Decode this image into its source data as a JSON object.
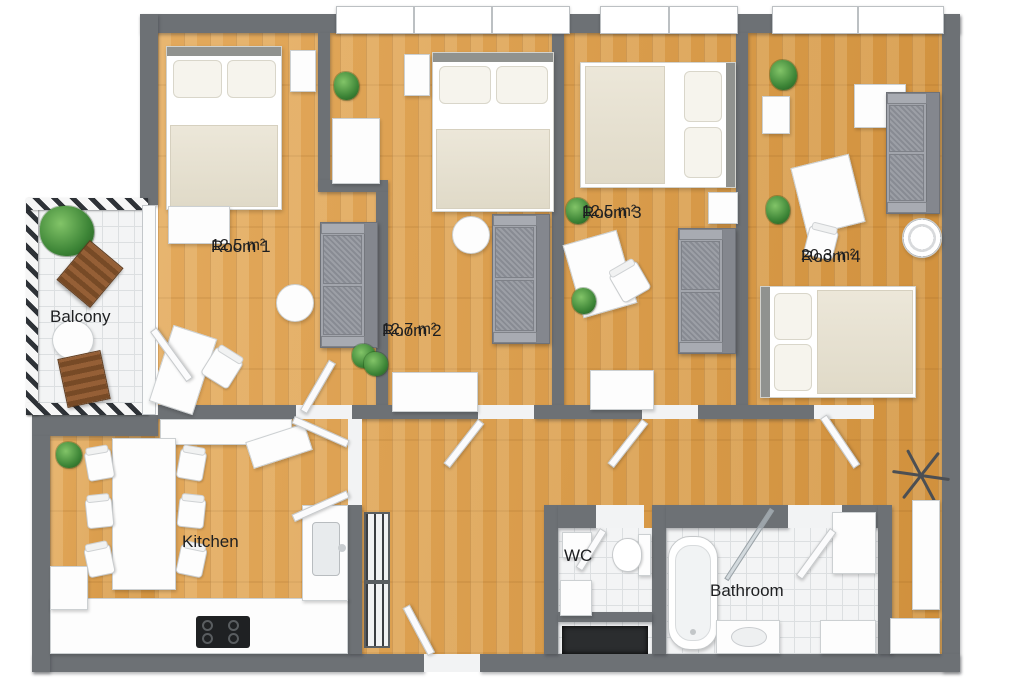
{
  "plan": {
    "type": "apartment-floor-plan-3d",
    "rooms": [
      {
        "id": "room-1",
        "name": "Room 1",
        "area": "12,5 m²"
      },
      {
        "id": "room-2",
        "name": "Room 2",
        "area": "12,7 m²"
      },
      {
        "id": "room-3",
        "name": "Room 3",
        "area": "12,5 m²"
      },
      {
        "id": "room-4",
        "name": "Room 4",
        "area": "20,3 m²"
      },
      {
        "id": "balcony",
        "name": "Balcony",
        "area": ""
      },
      {
        "id": "kitchen",
        "name": "Kitchen",
        "area": ""
      },
      {
        "id": "wc",
        "name": "WC",
        "area": ""
      },
      {
        "id": "bathroom",
        "name": "Bathroom",
        "area": ""
      }
    ],
    "colors": {
      "wall": "#6d7175",
      "wood_floor": "#d99c48",
      "tile_floor": "#f3f4f5",
      "sofa_gray": "#91949c",
      "bed_duvet": "#e9e4d6",
      "plant_green": "#3c8436",
      "outdoor_chair_wood": "#8a5a33",
      "cooktop_black": "#1f2123",
      "label_text": "#1e1f21"
    },
    "furniture_icons": [
      "double-bed-icon",
      "sofa-icon",
      "desk-icon",
      "chair-icon",
      "wardrobe-icon",
      "dresser-icon",
      "nightstand-icon",
      "round-table-icon",
      "plant-icon",
      "dining-table-icon",
      "kitchen-counter-icon",
      "cooktop-icon",
      "kitchen-sink-icon",
      "radiator-icon",
      "toilet-icon",
      "hand-basin-icon",
      "bathtub-icon",
      "shower-glass-icon",
      "vanity-sink-icon",
      "washing-machine-icon",
      "cabinet-icon",
      "drying-rack-icon",
      "balcony-chair-icon",
      "balcony-table-icon",
      "window-icon",
      "door-icon",
      "doormat-icon",
      "balcony-railing-icon"
    ]
  }
}
